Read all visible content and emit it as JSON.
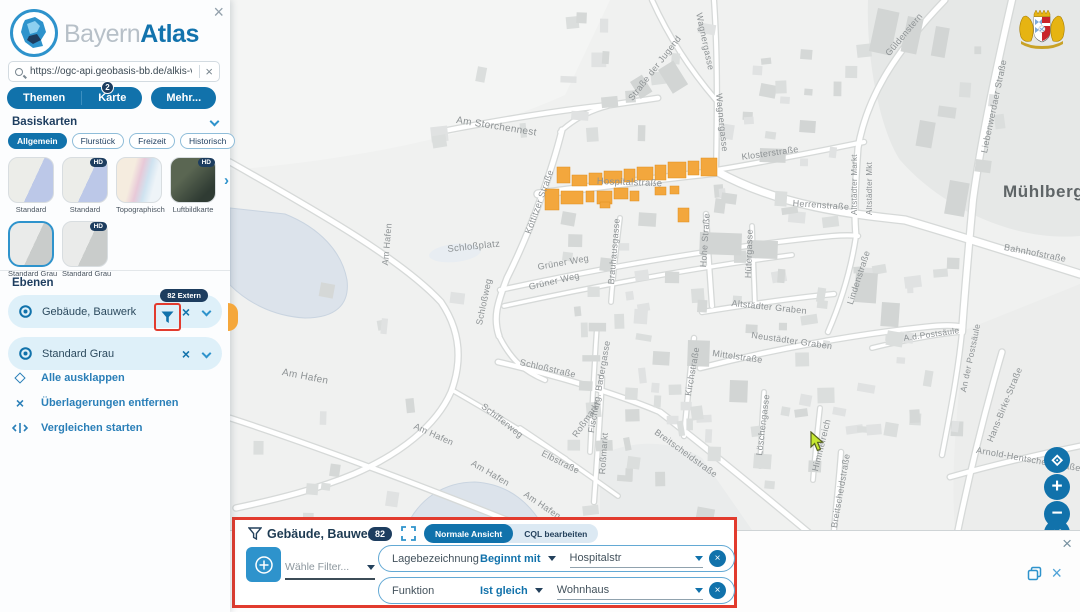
{
  "sidebar": {
    "logo_bayern": "Bayern",
    "logo_atlas": "Atlas",
    "search_value": "https://ogc-api.geobasis-bb.de/alkis-verein",
    "tabs": {
      "themen": "Themen",
      "karte": "Karte",
      "karte_badge": "2",
      "mehr": "Mehr..."
    },
    "basiskarten": {
      "title": "Basiskarten",
      "hd_label": "HD",
      "categories": [
        {
          "label": "Allgemein",
          "active": true
        },
        {
          "label": "Flurstück",
          "active": false
        },
        {
          "label": "Freizeit",
          "active": false
        },
        {
          "label": "Historisch",
          "active": false
        }
      ],
      "thumbs": [
        {
          "label": "Standard",
          "style": "standard",
          "hd": false,
          "selected": false
        },
        {
          "label": "Standard",
          "style": "standard",
          "hd": true,
          "selected": false
        },
        {
          "label": "Topographisch",
          "style": "topo",
          "hd": false,
          "selected": false
        },
        {
          "label": "Luftbildkarte",
          "style": "luftbild",
          "hd": true,
          "selected": false
        },
        {
          "label": "Standard Grau",
          "style": "grau",
          "hd": false,
          "selected": true
        },
        {
          "label": "Standard Grau",
          "style": "grau",
          "hd": true,
          "selected": false
        }
      ]
    },
    "ebenen": {
      "title": "Ebenen",
      "layers": [
        {
          "name": "Gebäude, Bauwerk",
          "badge": "82 Extern",
          "has_filter": true
        },
        {
          "name": "Standard Grau",
          "badge": "",
          "has_filter": false
        }
      ],
      "actions": [
        {
          "label": "Alle ausklappen",
          "icon": "expand-all-icon"
        },
        {
          "label": "Überlagerungen entfernen",
          "icon": "close-icon"
        },
        {
          "label": "Vergleichen starten",
          "icon": "compare-icon"
        }
      ]
    }
  },
  "filter_panel": {
    "title": "Gebäude, Bauwerk",
    "badge": "82",
    "view_normal": "Normale Ansicht",
    "view_cql": "CQL bearbeiten",
    "active_view": "Normale Ansicht",
    "filter_select_placeholder": "Wähle Filter...",
    "rows": [
      {
        "field": "Lagebezeichnung",
        "operator": "Beginnt mit",
        "value": "Hospitalstr"
      },
      {
        "field": "Funktion",
        "operator": "Ist gleich",
        "value": "Wohnhaus"
      }
    ]
  },
  "map": {
    "place_label": "Mühlberg",
    "highlight_color": "#f3a73d",
    "labels": [
      {
        "t": "Am Storchennest",
        "x": 457,
        "y": 116,
        "r": 9,
        "s": 10
      },
      {
        "t": "Straße der Jugend",
        "x": 627,
        "y": 97,
        "r": -52,
        "s": 9
      },
      {
        "t": "Wagnergasse",
        "x": 703,
        "y": 12,
        "r": 78,
        "s": 9
      },
      {
        "t": "Wagnergasse",
        "x": 723,
        "y": 93,
        "r": 84,
        "s": 9
      },
      {
        "t": "Güldenstern",
        "x": 884,
        "y": 52,
        "r": -50,
        "s": 9
      },
      {
        "t": "Liebenwerdaer Straße",
        "x": 980,
        "y": 152,
        "r": -78,
        "s": 9
      },
      {
        "t": "Klosterstraße",
        "x": 741,
        "y": 153,
        "r": -8,
        "s": 9
      },
      {
        "t": "Altstädter Markt",
        "x": 851,
        "y": 215,
        "r": -90,
        "s": 8
      },
      {
        "t": "Altstädter Mkt",
        "x": 866,
        "y": 215,
        "r": -90,
        "s": 8
      },
      {
        "t": "Herrenstraße",
        "x": 793,
        "y": 199,
        "r": 4,
        "s": 9
      },
      {
        "t": "Bahnhofstraße",
        "x": 1005,
        "y": 243,
        "r": 11,
        "s": 9
      },
      {
        "t": "Hospitalstraße",
        "x": 597,
        "y": 177,
        "r": 2,
        "s": 9.5
      },
      {
        "t": "Köttitzer Straße",
        "x": 524,
        "y": 232,
        "r": -70,
        "s": 9
      },
      {
        "t": "Hohe Straße",
        "x": 699,
        "y": 267,
        "r": -86,
        "s": 9
      },
      {
        "t": "Hütergasse",
        "x": 744,
        "y": 278,
        "r": -88,
        "s": 9
      },
      {
        "t": "Grüner Weg",
        "x": 537,
        "y": 263,
        "r": -10,
        "s": 9
      },
      {
        "t": "Grüner Weg",
        "x": 528,
        "y": 283,
        "r": -13,
        "s": 9
      },
      {
        "t": "Brauhausgasse",
        "x": 607,
        "y": 284,
        "r": -85,
        "s": 9
      },
      {
        "t": "Schloßplatz",
        "x": 447,
        "y": 245,
        "r": -6,
        "s": 9.5
      },
      {
        "t": "Schloßweg",
        "x": 475,
        "y": 324,
        "r": -78,
        "s": 9
      },
      {
        "t": "Am Hafen",
        "x": 381,
        "y": 265,
        "r": -85,
        "s": 9
      },
      {
        "t": "Am Hafen",
        "x": 283,
        "y": 368,
        "r": 11,
        "s": 10
      },
      {
        "t": "Am Hafen",
        "x": 416,
        "y": 422,
        "r": 24,
        "s": 9
      },
      {
        "t": "Am Hafen",
        "x": 474,
        "y": 459,
        "r": 30,
        "s": 9
      },
      {
        "t": "Am Hafen",
        "x": 527,
        "y": 490,
        "r": 34,
        "s": 9
      },
      {
        "t": "Altstädter Graben",
        "x": 732,
        "y": 299,
        "r": 6,
        "s": 9
      },
      {
        "t": "Neustädter Graben",
        "x": 752,
        "y": 331,
        "r": 8,
        "s": 9
      },
      {
        "t": "Mittelstraße",
        "x": 713,
        "y": 349,
        "r": 8,
        "s": 9
      },
      {
        "t": "Lindenstraße",
        "x": 846,
        "y": 303,
        "r": -72,
        "s": 9
      },
      {
        "t": "A.d.Postsäule",
        "x": 903,
        "y": 334,
        "r": -8,
        "s": 8.5
      },
      {
        "t": "An der Postsäule",
        "x": 959,
        "y": 391,
        "r": -78,
        "s": 8.5
      },
      {
        "t": "Hans-Birke-Straße",
        "x": 986,
        "y": 440,
        "r": -68,
        "s": 9
      },
      {
        "t": "Arnold-Hentschel-Straße",
        "x": 977,
        "y": 446,
        "r": 10,
        "s": 9
      },
      {
        "t": "Schloßstraße",
        "x": 521,
        "y": 358,
        "r": 13,
        "s": 9
      },
      {
        "t": "Fischerg. Badergasse",
        "x": 587,
        "y": 432,
        "r": -80,
        "s": 9
      },
      {
        "t": "Roßmarkt",
        "x": 571,
        "y": 434,
        "r": -55,
        "s": 9
      },
      {
        "t": "Roßmarkt",
        "x": 598,
        "y": 474,
        "r": -86,
        "s": 9
      },
      {
        "t": "Kirchstraße",
        "x": 684,
        "y": 395,
        "r": -80,
        "s": 9
      },
      {
        "t": "Breitscheidstraße",
        "x": 658,
        "y": 428,
        "r": 36,
        "s": 9
      },
      {
        "t": "Breitscheidstraße",
        "x": 830,
        "y": 527,
        "r": -80,
        "s": 9
      },
      {
        "t": "Löschengasse",
        "x": 755,
        "y": 455,
        "r": -83,
        "s": 9
      },
      {
        "t": "Himmelreich",
        "x": 811,
        "y": 470,
        "r": -76,
        "s": 9
      },
      {
        "t": "Elbstraße",
        "x": 544,
        "y": 449,
        "r": 27,
        "s": 9
      },
      {
        "t": "Schifferweg",
        "x": 485,
        "y": 402,
        "r": 38,
        "s": 9
      },
      {
        "t": "Mühlberg",
        "x": 1003,
        "y": 183,
        "r": 0,
        "s": 17,
        "major": true
      }
    ],
    "highlighted_buildings": [
      [
        557,
        167,
        13,
        16
      ],
      [
        572,
        175,
        15,
        11
      ],
      [
        589,
        173,
        13,
        12
      ],
      [
        604,
        171,
        18,
        12
      ],
      [
        624,
        169,
        11,
        13
      ],
      [
        637,
        167,
        16,
        13
      ],
      [
        655,
        165,
        11,
        15
      ],
      [
        668,
        162,
        18,
        16
      ],
      [
        688,
        161,
        11,
        14
      ],
      [
        701,
        158,
        16,
        18
      ],
      [
        545,
        189,
        14,
        21
      ],
      [
        561,
        191,
        22,
        13
      ],
      [
        586,
        191,
        8,
        11
      ],
      [
        597,
        191,
        15,
        13
      ],
      [
        614,
        188,
        14,
        11
      ],
      [
        600,
        202,
        10,
        6
      ],
      [
        630,
        191,
        9,
        10
      ],
      [
        655,
        187,
        11,
        8
      ],
      [
        670,
        186,
        9,
        8
      ],
      [
        678,
        208,
        11,
        14
      ]
    ]
  },
  "colors": {
    "brand_blue": "#1172ab",
    "light_blue_row": "#def0f9",
    "navy_badge": "#1d3d5f",
    "annotation_red": "#e23b2e",
    "highlight_orange": "#f3a73d"
  }
}
